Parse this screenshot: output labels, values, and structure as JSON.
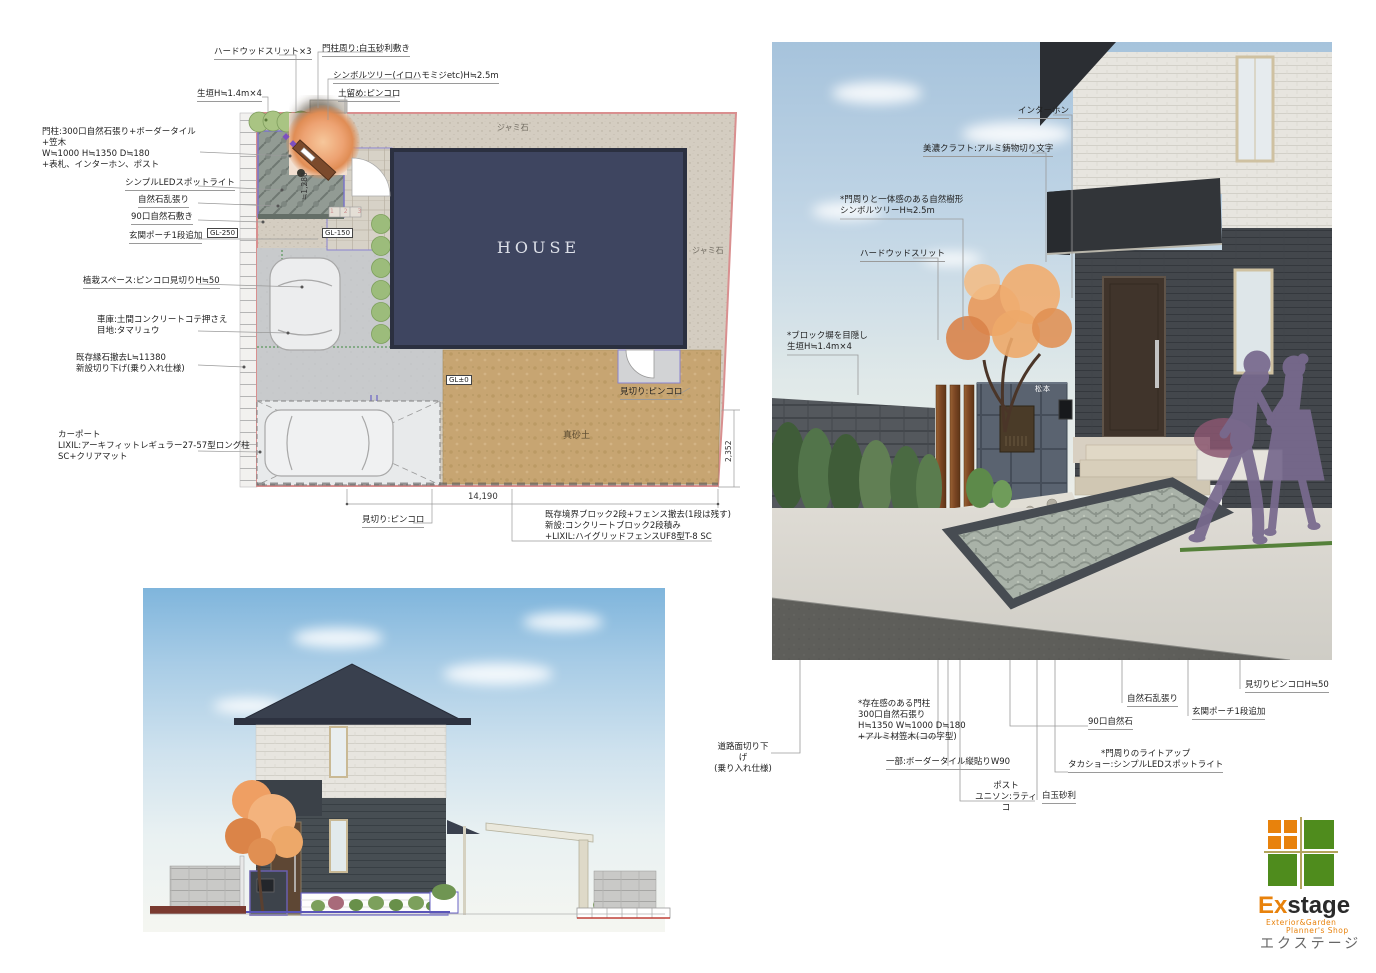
{
  "plan": {
    "top_labels": [
      "ハードウッドスリット×3",
      "門柱周り:白玉砂利敷き",
      "シンボルツリー(イロハモミジetc)H≒2.5m",
      "生垣H≒1.4m×4",
      "土留め:ピンコロ"
    ],
    "left_labels": [
      "門柱:300口自然石張り+ボーダータイル+笠木\nW≒1000 H≒1350 D≒180\n+表札、インターホン、ポスト",
      "シンプルLEDスポットライト",
      "自然石乱張り",
      "90口自然石敷き",
      "玄関ポーチ1段追加",
      "植栽スペース:ピンコロ見切りH≒50",
      "車庫:土間コンクリートコテ押さえ\n目地:タマリュウ",
      "既存縁石撤去L≒11380\n新設切り下げ(乗り入れ仕様)",
      "カーポート\nLIXIL:アーキフィットレギュラー27-57型ロング柱\nSC+クリアマット"
    ],
    "gl": [
      "GL-250",
      "GL-150",
      "GL±0"
    ],
    "area": {
      "house": "HOUSE",
      "gravel": "ジャミ石",
      "masago": "真砂土",
      "steps": "1 2 3"
    },
    "dims": {
      "w": "14,190",
      "h": "2,352",
      "entry": "≒1,280"
    },
    "notes": {
      "mikiri": "見切り:ピンコロ",
      "fence": "既存境界ブロック2段+フェンス撤去(1段は残す)\n新設:コンクリートブロック2段積み\n+LIXIL:ハイグリッドフェンスUF8型T-8  SC"
    }
  },
  "render": {
    "labels": [
      "インターホン",
      "美濃クラフト:アルミ鋳物切り文字",
      "*門周りと一体感のある自然樹形\nシンボルツリーH≒2.5m",
      "ハードウッドスリット",
      "*ブロック塀を目隠し\n生垣H≒1.4m×4"
    ],
    "nameplate": "松本",
    "bottom_labels": [
      "道路面切り下げ\n(乗り入れ仕様)",
      "*存在感のある門柱\n300口自然石張り\nH≒1350 W≒1000 D≒180\n+アルミ材笠木(コの字型)",
      "一部:ボーダータイル縦貼りW90",
      "ポスト\nユニソン:ラティコ",
      "白玉砂利",
      "90口自然石",
      "*門周りのライトアップ\nタカショー:シンプルLEDスポットライト",
      "自然石乱張り",
      "玄関ポーチ1段追加",
      "見切りピンコロH≒50"
    ]
  },
  "logo": {
    "ex": "Ex",
    "stage": "stage",
    "sub1": "Exterior&Garden",
    "sub2": "Planner's Shop",
    "katakana": "エクステージ"
  },
  "colors": {
    "accent_orange": "#e8820c",
    "logo_green": "#4f8c1d",
    "boundary_pink": "#d98f8f",
    "house_navy": "#3e4560",
    "silhouette_purple": "#786a8e"
  }
}
